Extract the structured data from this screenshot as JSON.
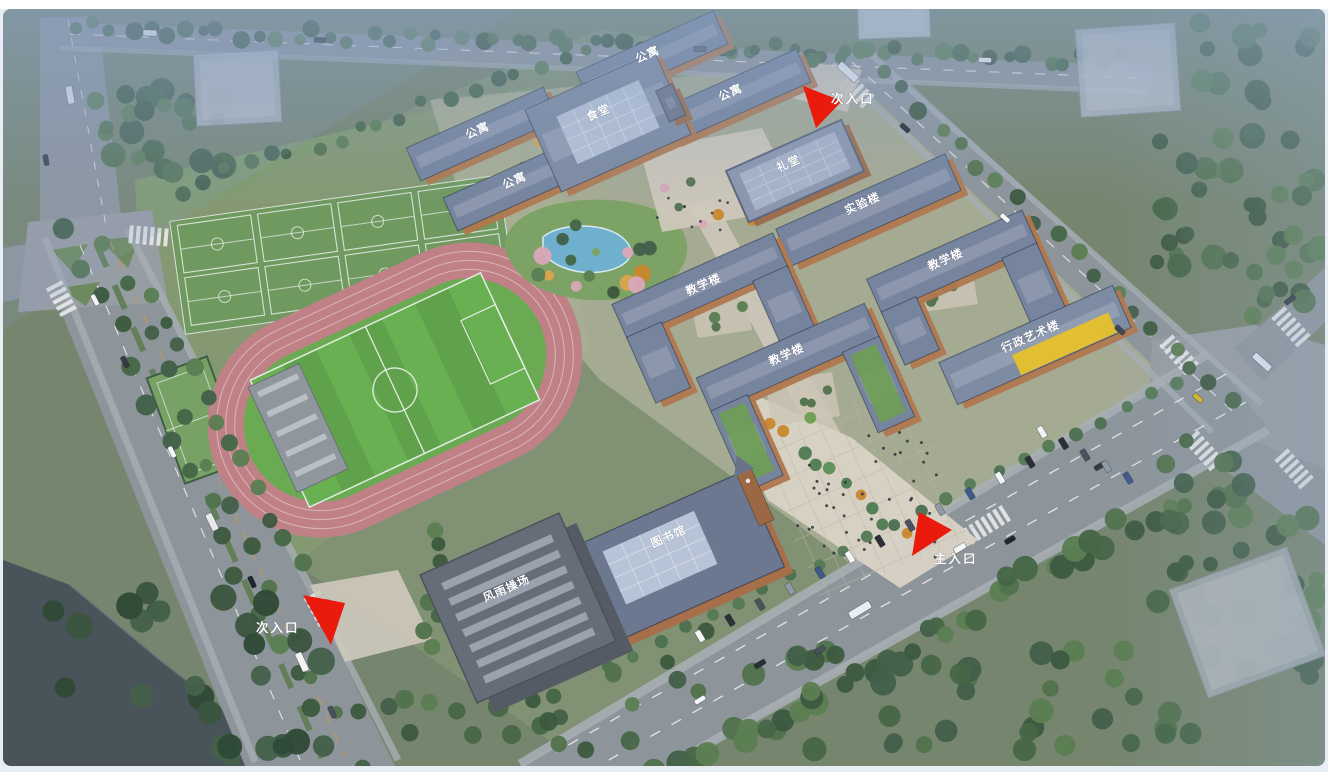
{
  "scene": {
    "type": "aerial-campus-architectural-rendering",
    "colors": {
      "entrance_arrow": "#ea1b0d",
      "label_text": "#ffffff",
      "track": "#bf8186",
      "pitch": "#5fa24b",
      "courts": "#6f9a60",
      "roof_blue": "#76849e",
      "roof_glass": "#b7c3d6",
      "facade_brick": "#b0784e",
      "admin_roof_accent": "#e7c12c",
      "pond": "#6fb0cf",
      "road": "#8d959b",
      "water": "#49545a"
    },
    "building_labels": [
      {
        "id": "apartment-north",
        "label": "公寓",
        "x": 649,
        "y": 58
      },
      {
        "id": "apartment-northeast",
        "label": "公寓",
        "x": 732,
        "y": 96
      },
      {
        "id": "apartment-west",
        "label": "公寓",
        "x": 479,
        "y": 134
      },
      {
        "id": "apartment-southwest",
        "label": "公寓",
        "x": 516,
        "y": 184
      },
      {
        "id": "canteen",
        "label": "食堂",
        "x": 600,
        "y": 116
      },
      {
        "id": "auditorium",
        "label": "礼堂",
        "x": 790,
        "y": 167
      },
      {
        "id": "lab-building",
        "label": "实验楼",
        "x": 864,
        "y": 207
      },
      {
        "id": "teaching-building-east",
        "label": "教学楼",
        "x": 947,
        "y": 263
      },
      {
        "id": "teaching-building-center",
        "label": "教学楼",
        "x": 705,
        "y": 288
      },
      {
        "id": "teaching-building-south",
        "label": "教学楼",
        "x": 788,
        "y": 358
      },
      {
        "id": "admin-art-building",
        "label": "行政艺术楼",
        "x": 1032,
        "y": 340
      },
      {
        "id": "library",
        "label": "图书馆",
        "x": 670,
        "y": 540
      },
      {
        "id": "indoor-sports-hall",
        "label": "风雨操场",
        "x": 508,
        "y": 592
      }
    ],
    "entrance_labels": [
      {
        "id": "secondary-entrance-north",
        "label": "次入口",
        "x": 831,
        "y": 103
      },
      {
        "id": "main-entrance",
        "label": "主入口",
        "x": 934,
        "y": 563
      },
      {
        "id": "secondary-entrance-west",
        "label": "次入口",
        "x": 256,
        "y": 632
      }
    ]
  }
}
